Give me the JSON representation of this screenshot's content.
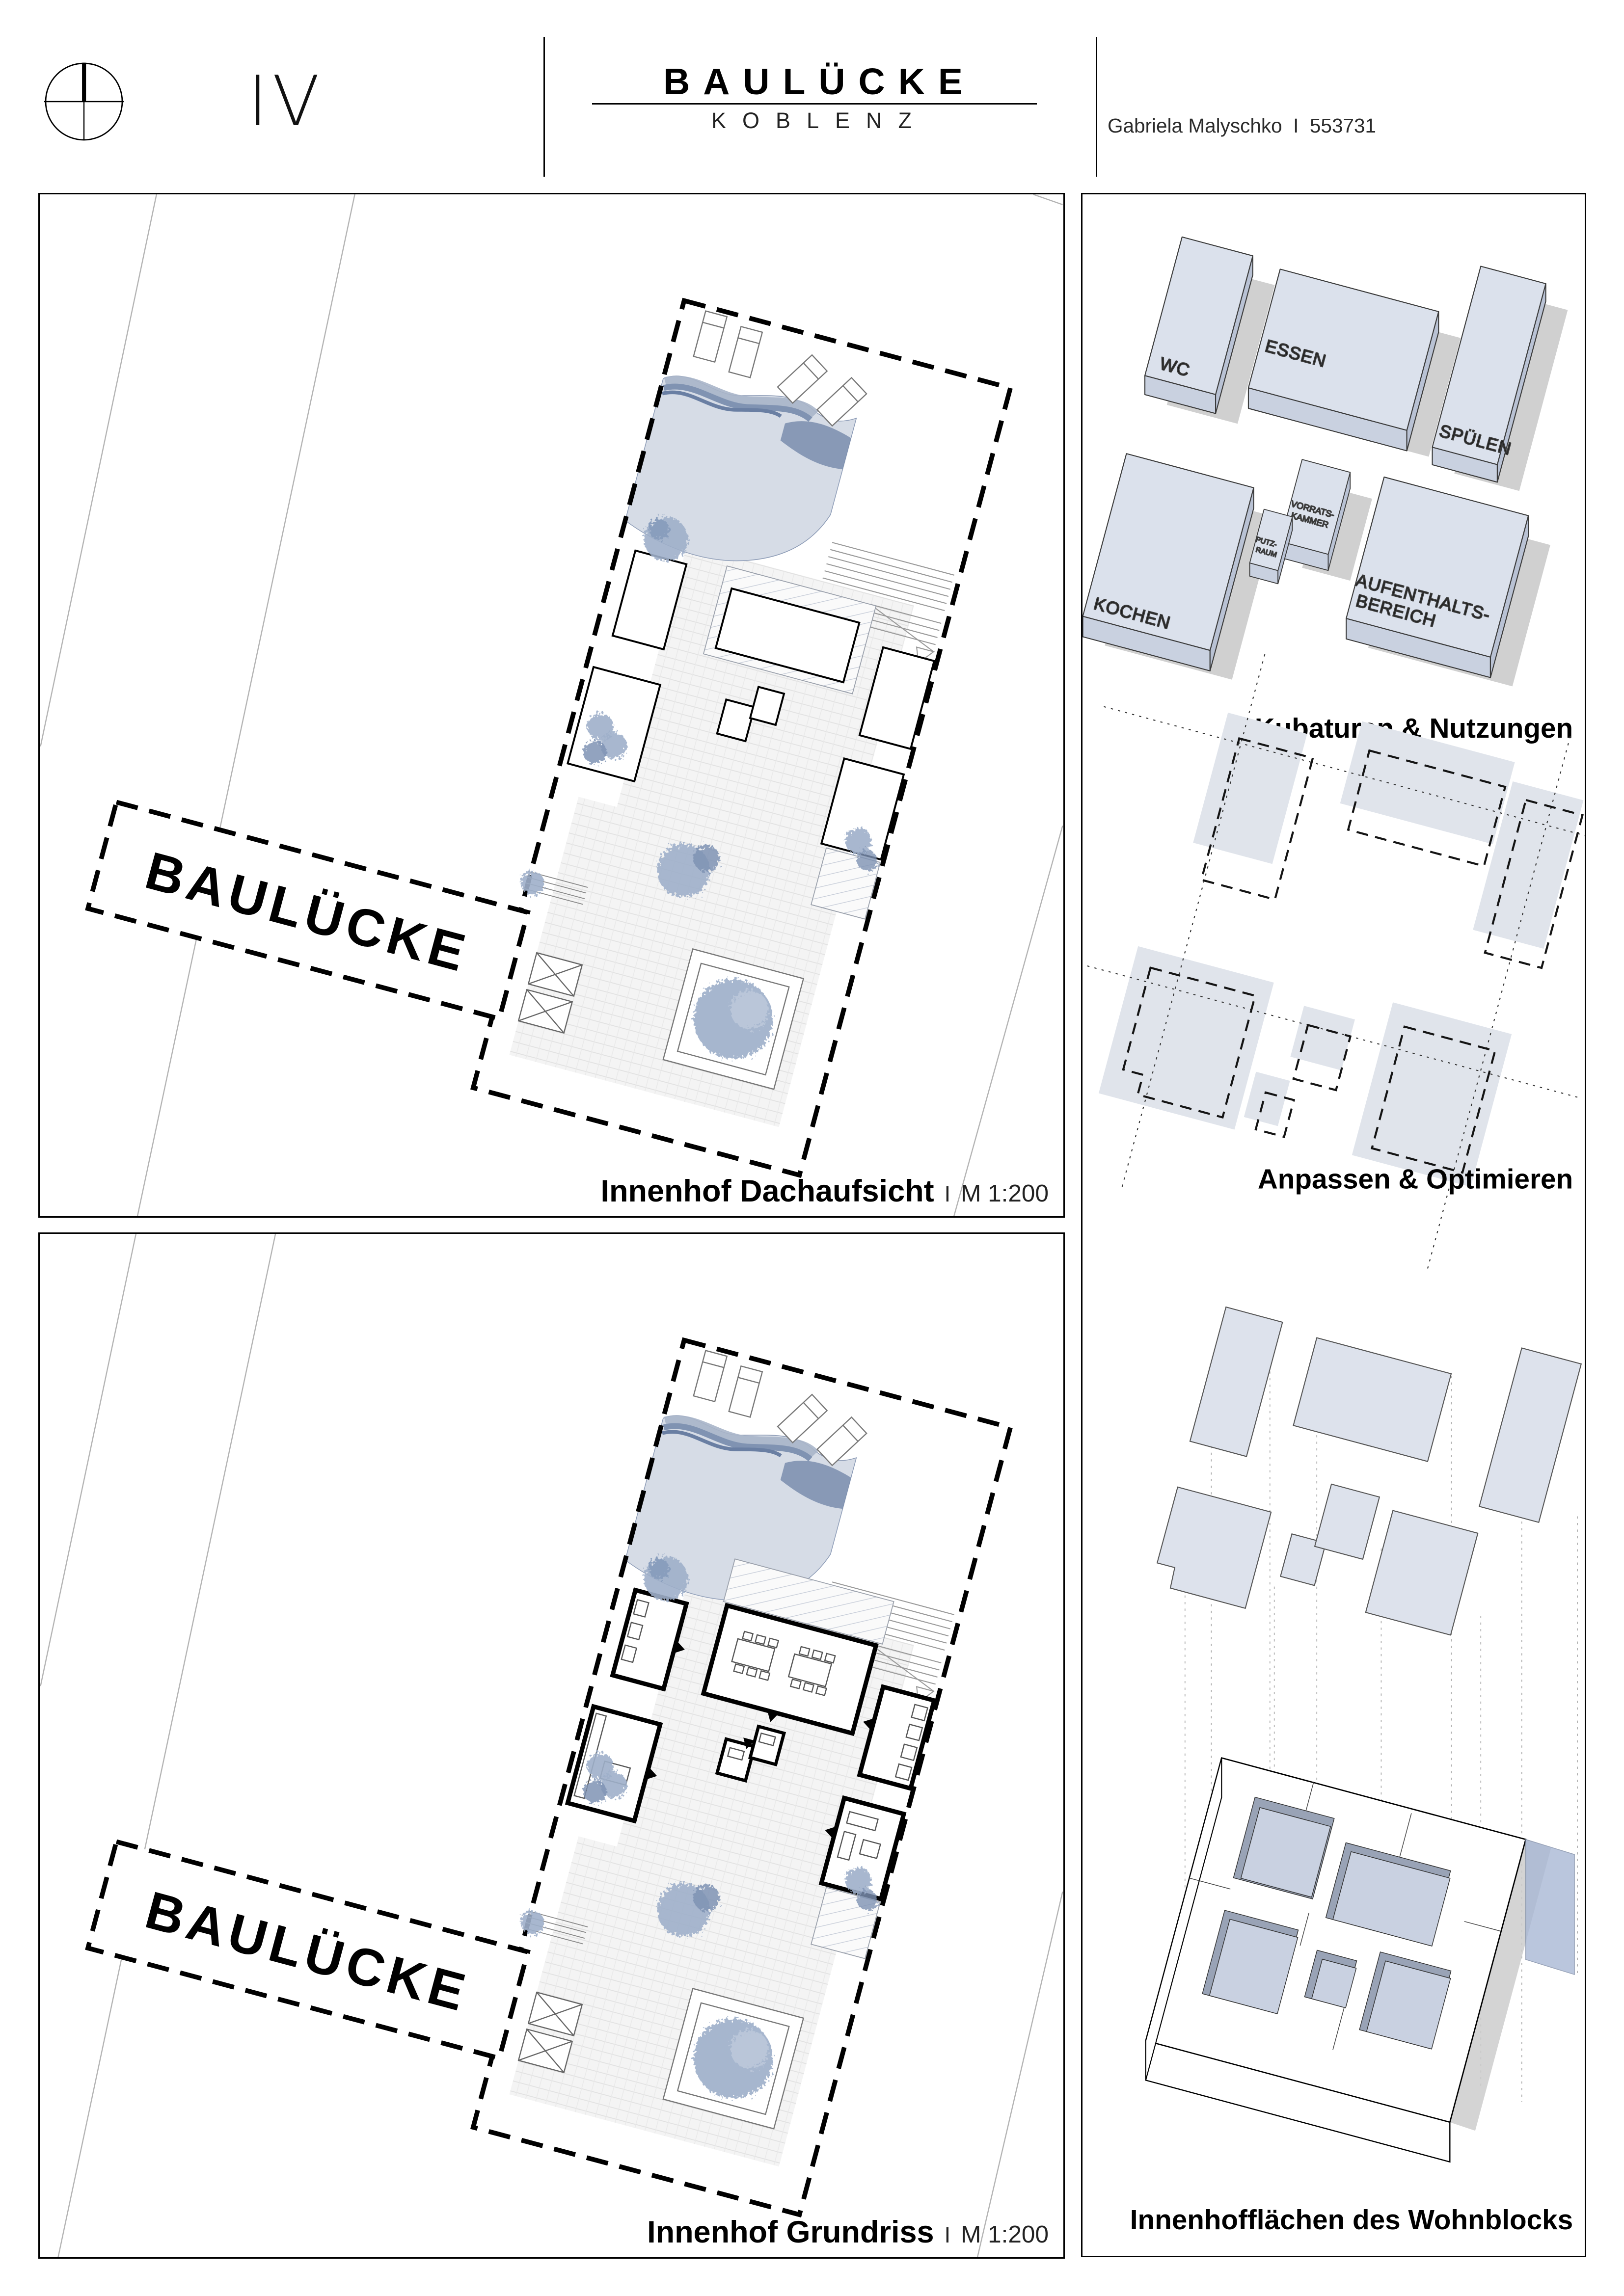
{
  "header": {
    "sheet_number": "IV",
    "title": "BAULÜCKE",
    "subtitle": "KOBLENZ",
    "credit_name": "Gabriela Malyschko  I  553731",
    "credit_course": "WM - HowTo",
    "credit_supervisor": "I M.A. Sophie Hofmann"
  },
  "roof_plan": {
    "site_label": "BAULÜCKE",
    "caption": "Innenhof Dachaufsicht",
    "caption_sep": "I",
    "caption_scale": "M 1:200"
  },
  "floor_plan": {
    "site_label": "BAULÜCKE",
    "caption": "Innenhof Grundriss",
    "caption_sep": "I",
    "caption_scale": "M 1:200"
  },
  "massing": {
    "title": "Kubaturen & Nutzungen",
    "label_wc": "WC",
    "label_essen": "ESSEN",
    "label_spuelen": "SPÜLEN",
    "label_kochen": "KOCHEN",
    "label_putz_1": "PUTZ-",
    "label_putz_2": "RAUM",
    "label_vorrats_1": "VORRATS-",
    "label_vorrats_2": "KAMMER",
    "label_aufenthalt_1": "AUFENTHALTS-",
    "label_aufenthalt_2": "BEREICH"
  },
  "optimize": {
    "title": "Anpassen & Optimieren"
  },
  "courtyard": {
    "title": "Innenhofflächen des Wohnblocks"
  },
  "colors": {
    "block_top": "#dbe1ec",
    "block_front": "#c9d1e0",
    "block_side": "#b9c2d4",
    "shadow_gray": "#c8c8c8",
    "water_light": "#d6dce6",
    "water_mid": "#8ea0bd",
    "water_dark": "#6f83a6",
    "tree_blue": "#9fb0ca",
    "court_floor": "#c9d1e1",
    "court_wall": "#99a3b6",
    "glass_blue": "#a9b8d5",
    "line_black": "#000000"
  }
}
